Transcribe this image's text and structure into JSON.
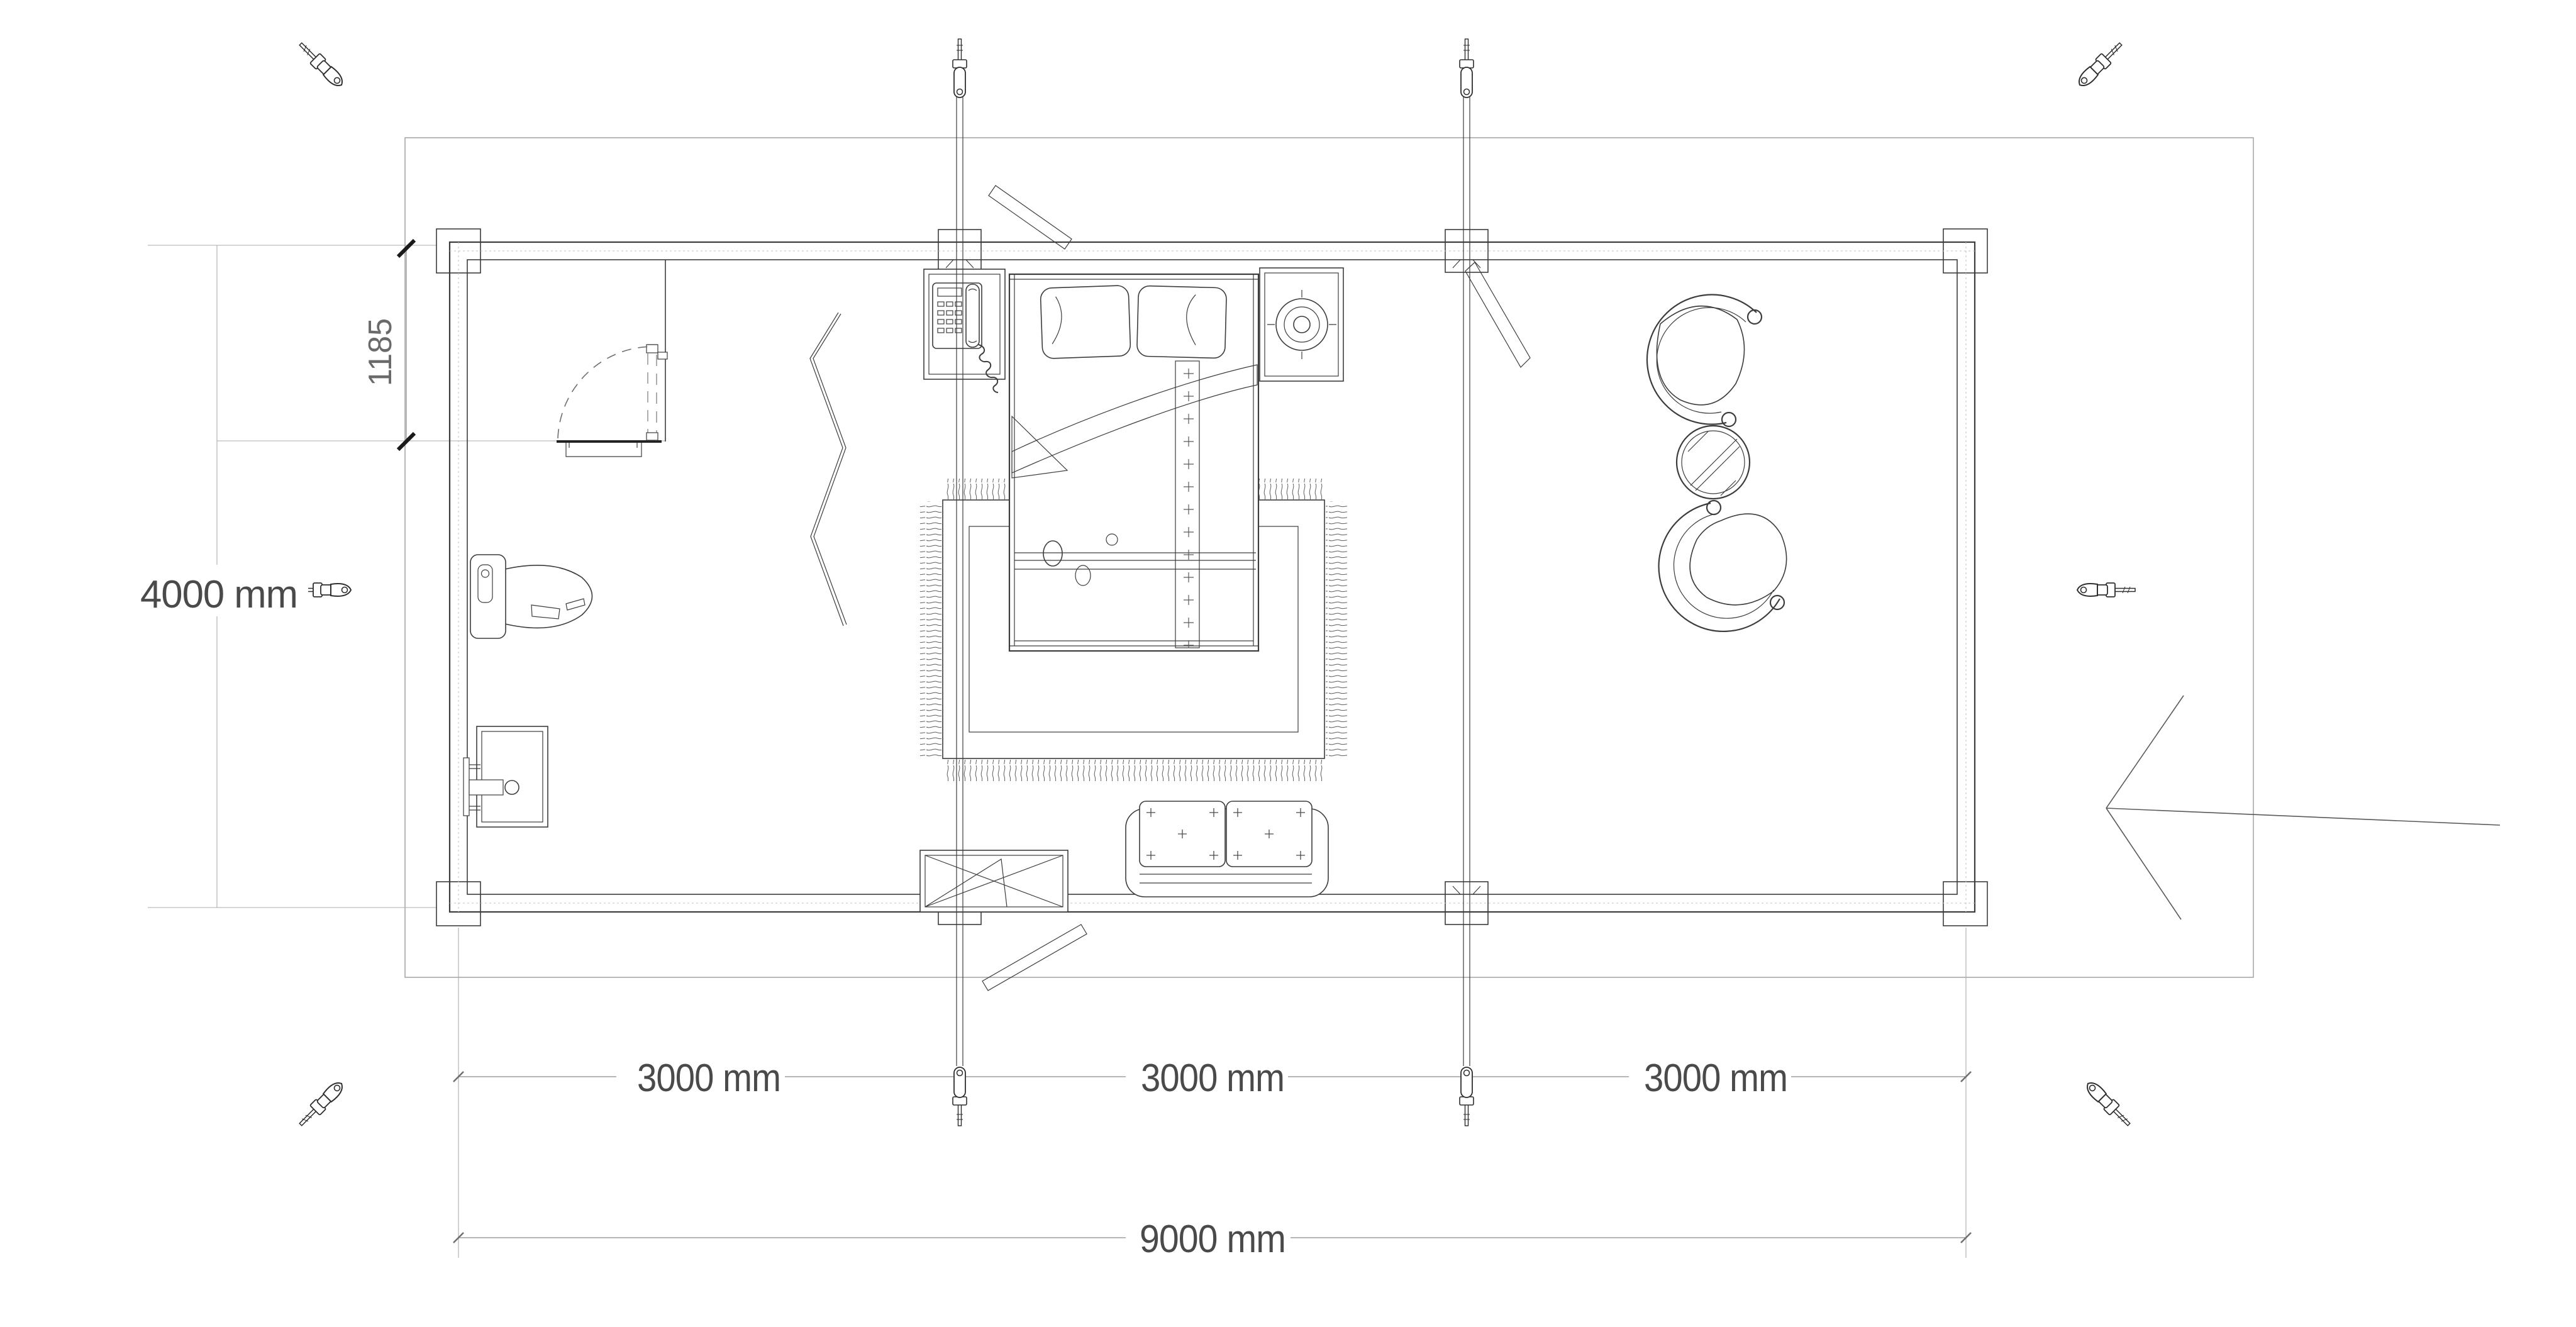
{
  "drawing": {
    "kind": "floor-plan",
    "dimensions": {
      "overall_width": "9000 mm",
      "bay_left": "3000 mm",
      "bay_middle": "3000 mm",
      "bay_right": "3000 mm",
      "overall_depth": "4000 mm",
      "partition_offset": "1185"
    },
    "colors": {
      "background": "#ffffff",
      "ink": "#3c3c3c",
      "dimension_lines": "#8a8a8a",
      "dimension_text": "#4a4a4a",
      "extension_lines": "#ababab"
    },
    "icons": {
      "fasteners": "turnbuckle-screw-icon",
      "tie_rods": "threaded-tie-rod-icon",
      "entrance": "entrance-arrow"
    }
  }
}
